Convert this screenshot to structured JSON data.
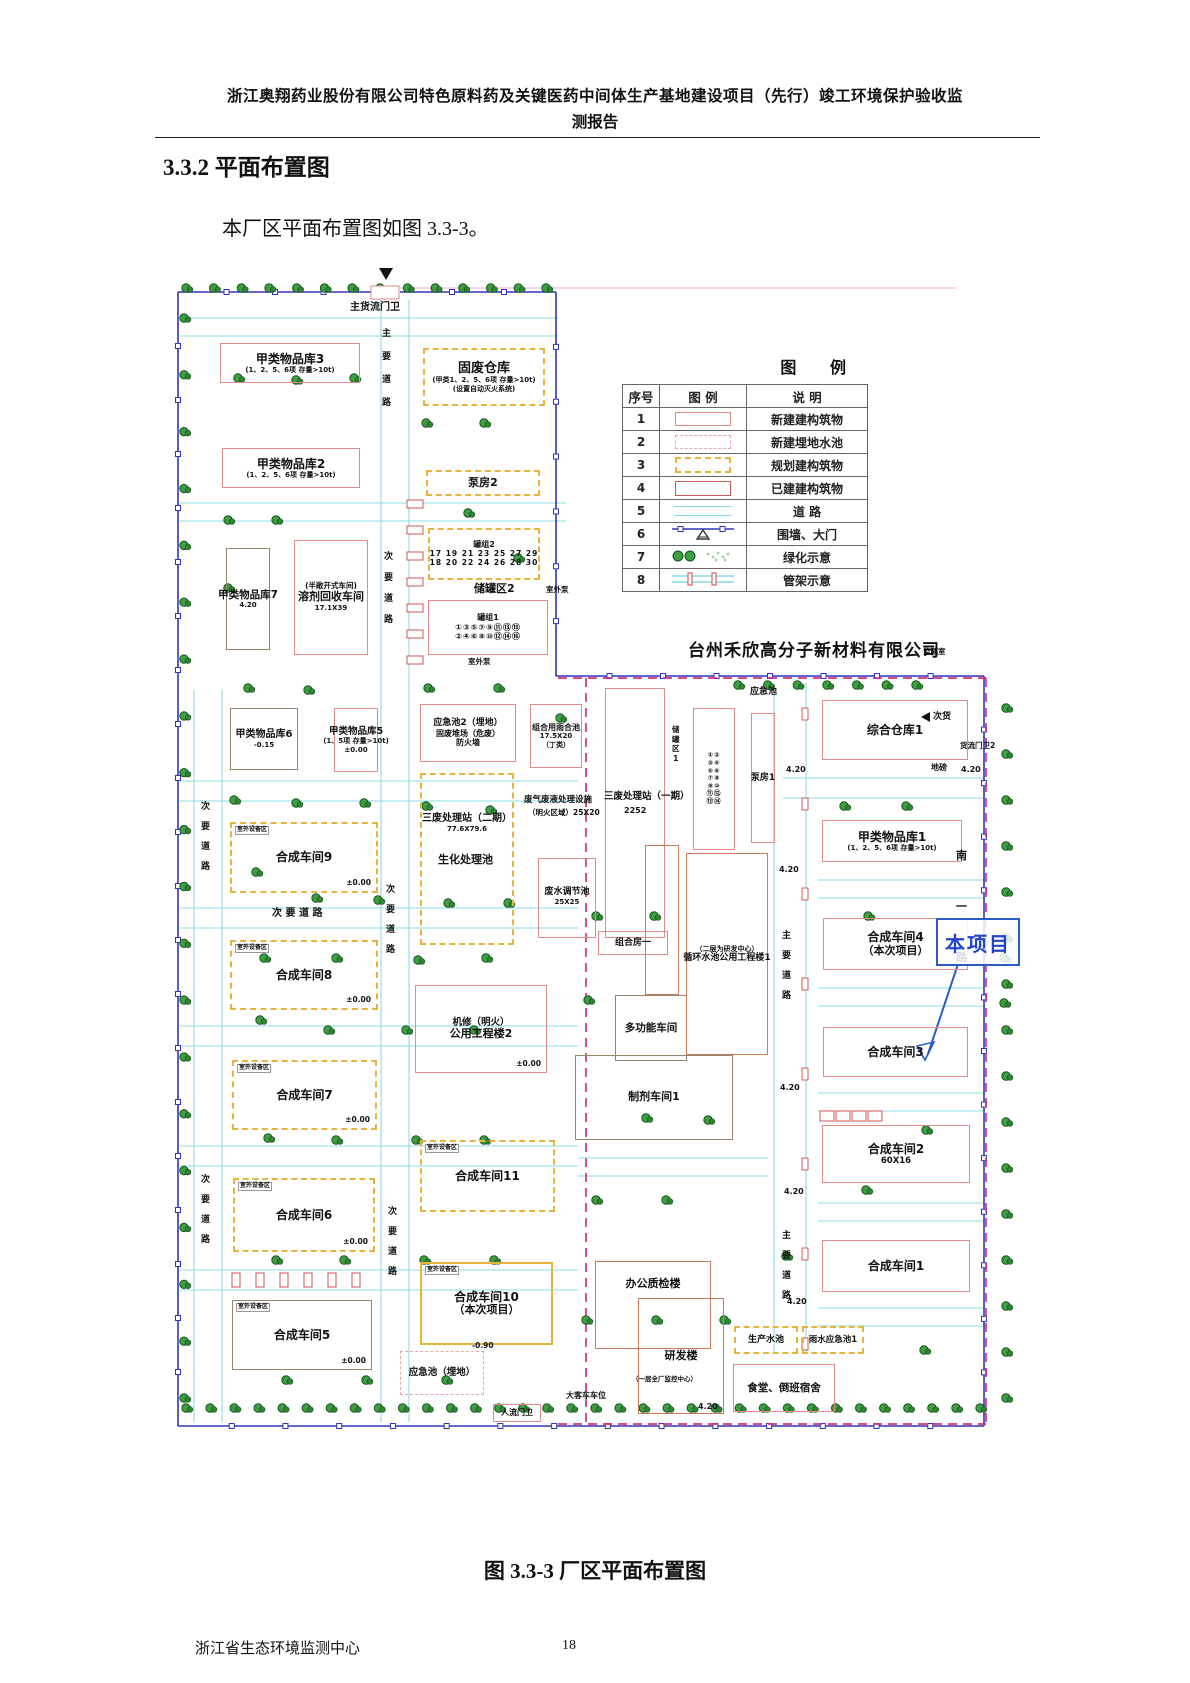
{
  "page": {
    "header_line1": "浙江奥翔药业股份有限公司特色原料药及关键医药中间体生产基地建设项目（先行）竣工环境保护验收监",
    "header_line2": "测报告",
    "section_heading": "3.3.2 平面布置图",
    "intro": "本厂区平面布置图如图 3.3-3。",
    "caption": "图 3.3-3  厂区平面布置图",
    "footer_org": "浙江省生态环境监测中心",
    "page_number": "18"
  },
  "legend": {
    "title": "图  例",
    "headers": [
      "序号",
      "图  例",
      "说  明"
    ],
    "rows": [
      {
        "no": "1",
        "swatch": "new-building",
        "desc": "新建建构筑物"
      },
      {
        "no": "2",
        "swatch": "new-buried-pool",
        "desc": "新建埋地水池"
      },
      {
        "no": "3",
        "swatch": "planned-building",
        "desc": "规划建构筑物"
      },
      {
        "no": "4",
        "swatch": "existing-building",
        "desc": "已建建构筑物"
      },
      {
        "no": "5",
        "swatch": "road",
        "desc": "道  路"
      },
      {
        "no": "6",
        "swatch": "wall-gate",
        "desc": "围墙、大门"
      },
      {
        "no": "7",
        "swatch": "greenery",
        "desc": "绿化示意"
      },
      {
        "no": "8",
        "swatch": "pipe-rack",
        "desc": "管架示意"
      }
    ]
  },
  "colors": {
    "new_building": "#e08a8a",
    "planned_building": "#e6b33c",
    "existing_building": "#cc5555",
    "gray_building": "#97866f",
    "orange_building": "#cc7a5a",
    "road": "#8adce4",
    "boundary_blue": "#3333bb",
    "boundary_magenta": "#d4317f",
    "tree_green": "#3f9d42",
    "callout_blue": "#2b5cc4"
  },
  "plan": {
    "neighbor_company": "台州禾欣高分子新材料有限公司",
    "callout": {
      "text": "本项目"
    },
    "buildings": [
      {
        "label": "甲类物品库3",
        "size": 12,
        "sub": [
          "(1、2、5、6项 存量>10t)"
        ],
        "type": "new",
        "rect": [
          52,
          85,
          140,
          40
        ]
      },
      {
        "label": "固废仓库",
        "size": 13,
        "sub": [
          "(甲类1、2、5、6项 存量>10t)",
          "(设置自动灭火系统)"
        ],
        "type": "planned",
        "rect": [
          255,
          90,
          122,
          58
        ]
      },
      {
        "label": "甲类物品库2",
        "size": 12,
        "sub": [
          "(1、2、5、6项 存量>10t)"
        ],
        "type": "new",
        "rect": [
          54,
          190,
          138,
          40
        ]
      },
      {
        "label": "泵房2",
        "size": 11,
        "type": "planned",
        "rect": [
          258,
          212,
          114,
          26
        ]
      },
      {
        "label": "甲类物品库7",
        "size": 10.5,
        "sub": [
          "4.20"
        ],
        "type": "gray",
        "rect": [
          58,
          290,
          44,
          102
        ]
      },
      {
        "label": "溶剂回收车间",
        "size": 11,
        "sub_top": "(半敞开式车间)",
        "subTopSize": 7.5,
        "sub": [
          "17.1X39"
        ],
        "type": "new",
        "rect": [
          126,
          282,
          74,
          115
        ]
      },
      {
        "label": "罐组2",
        "size": 8,
        "rows": [
          "17 19 21 23 25 27 29",
          "18 20 22 24 26 28 30"
        ],
        "rowSize": 7.5,
        "type": "planned",
        "rect": [
          260,
          270,
          112,
          52
        ]
      },
      {
        "label": "罐组1",
        "size": 8,
        "rows": [
          "①③⑤⑦⑨⑪⑬⑮",
          "②④⑥⑧⑩⑫⑭⑯"
        ],
        "rowSize": 8,
        "type": "new",
        "rect": [
          260,
          342,
          120,
          55
        ]
      },
      {
        "label": "甲类物品库6",
        "size": 10,
        "sub": [
          "-0.15"
        ],
        "type": "gray",
        "rect": [
          62,
          450,
          68,
          62
        ]
      },
      {
        "label": "甲类物品库5",
        "size": 9.5,
        "sub": [
          "(1、5项 存量>10t)",
          "±0.00"
        ],
        "type": "new",
        "rect": [
          166,
          450,
          44,
          64
        ]
      },
      {
        "label": "合成车间9",
        "size": 12,
        "corner": "室外设备区",
        "elev": "±0.00",
        "type": "planned",
        "rect": [
          62,
          564,
          148,
          71
        ]
      },
      {
        "label": "合成车间8",
        "size": 12,
        "corner": "室外设备区",
        "elev": "±0.00",
        "type": "planned",
        "rect": [
          62,
          682,
          148,
          70
        ]
      },
      {
        "label": "合成车间7",
        "size": 12,
        "corner": "室外设备区",
        "elev": "±0.00",
        "type": "planned",
        "rect": [
          64,
          802,
          145,
          70
        ]
      },
      {
        "label": "合成车间6",
        "size": 12,
        "corner": "室外设备区",
        "elev": "±0.00",
        "type": "planned",
        "rect": [
          65,
          920,
          142,
          74
        ]
      },
      {
        "label": "合成车间5",
        "size": 12,
        "corner": "室外设备区",
        "elev": "±0.00",
        "type": "gray",
        "rect": [
          64,
          1042,
          140,
          70
        ]
      },
      {
        "label": "应急池2（埋地）",
        "size": 9,
        "sub": [
          "固废堆场（危废）",
          "防火墙"
        ],
        "subSize": 8,
        "type": "new",
        "rect": [
          252,
          446,
          96,
          58
        ]
      },
      {
        "label": "组合用雨合池",
        "size": 8,
        "sub": [
          "17.5X20",
          "（丁类）"
        ],
        "type": "new",
        "rect": [
          362,
          446,
          52,
          64
        ]
      },
      {
        "label": "三废处理站（二期）",
        "size": 10,
        "sub": [
          "77.6X79.6"
        ],
        "align": "top",
        "padTop": 38,
        "type": "planned",
        "rect": [
          252,
          515,
          94,
          172
        ]
      },
      {
        "label": "公用工程楼2",
        "size": 11,
        "sub_top": "机修（明火）",
        "subTopSize": 9.5,
        "elev": "±0.00",
        "type": "new",
        "rect": [
          247,
          727,
          132,
          88
        ]
      },
      {
        "label": "合成车间11",
        "size": 12,
        "corner": "室外设备区",
        "type": "planned",
        "rect": [
          252,
          882,
          135,
          72
        ]
      },
      {
        "label": "合成车间10",
        "size": 12,
        "sub": [
          "（本次项目）"
        ],
        "subSize": 11,
        "corner": "室外设备区",
        "type": "current",
        "rect": [
          252,
          1004,
          133,
          83
        ]
      },
      {
        "label": "应急池（埋地）",
        "size": 9.5,
        "type": "buried",
        "rect": [
          232,
          1093,
          84,
          44
        ]
      },
      {
        "label": "人流门卫",
        "size": 8,
        "type": "new",
        "rect": [
          325,
          1146,
          48,
          18
        ]
      },
      {
        "label": "废水调节池",
        "size": 9,
        "sub": [
          "25X25"
        ],
        "align": "top",
        "padTop": 28,
        "type": "new",
        "rect": [
          370,
          600,
          58,
          80
        ]
      },
      {
        "label": "",
        "type": "new",
        "rect": [
          437,
          430,
          60,
          250
        ]
      },
      {
        "label": "",
        "rows": [
          "①②",
          "③④",
          "⑤⑥",
          "⑦⑧",
          "⑨⑩",
          "⑪⑫",
          "⑬⑭"
        ],
        "rowSize": 6.5,
        "type": "new",
        "rect": [
          525,
          450,
          42,
          142
        ]
      },
      {
        "label": "泵房1",
        "size": 9,
        "type": "new",
        "rect": [
          583,
          455,
          24,
          130
        ]
      },
      {
        "label": "综合仓库1",
        "size": 12,
        "type": "new",
        "rect": [
          654,
          442,
          146,
          60
        ]
      },
      {
        "label": "甲类物品库1",
        "size": 12,
        "sub": [
          "(1、2、5、6项 存量>10t)"
        ],
        "type": "new",
        "rect": [
          654,
          562,
          140,
          42
        ]
      },
      {
        "label": "合成车间4",
        "size": 12,
        "sub": [
          "（本次项目）"
        ],
        "subSize": 11,
        "type": "new",
        "rect": [
          655,
          660,
          145,
          52
        ]
      },
      {
        "label": "合成车间3",
        "size": 12,
        "type": "new",
        "rect": [
          655,
          769,
          145,
          50
        ]
      },
      {
        "label": "合成车间2",
        "size": 12,
        "sub": [
          "60X16"
        ],
        "subSize": 8.5,
        "type": "new",
        "rect": [
          654,
          867,
          148,
          58
        ]
      },
      {
        "label": "合成车间1",
        "size": 12,
        "type": "new",
        "rect": [
          654,
          982,
          148,
          52
        ]
      },
      {
        "label": "生产水池",
        "size": 9,
        "type": "planned",
        "rect": [
          566,
          1068,
          64,
          28
        ]
      },
      {
        "label": "雨水应急池1",
        "size": 8.5,
        "type": "planned",
        "rect": [
          634,
          1068,
          62,
          28
        ]
      },
      {
        "label": "食堂、倒班宿舍",
        "size": 10.5,
        "type": "new",
        "rect": [
          565,
          1106,
          102,
          48
        ]
      },
      {
        "label": "办公质检楼",
        "size": 11,
        "align": "top",
        "padTop": 16,
        "type": "orange",
        "rect": [
          427,
          1003,
          116,
          88
        ]
      },
      {
        "label": "研发楼",
        "size": 11,
        "type": "orange",
        "rect": [
          470,
          1040,
          86,
          116
        ]
      },
      {
        "label": "多功能车间",
        "size": 10.5,
        "type": "gray",
        "rect": [
          447,
          737,
          72,
          66
        ]
      },
      {
        "label": "制剂车间1",
        "size": 11,
        "type": "gray",
        "rect": [
          407,
          797,
          158,
          85
        ]
      },
      {
        "label": "循环水池公用工程楼1",
        "size": 9,
        "sub_top": "（二层为研发中心）",
        "subTopSize": 7,
        "type": "orange",
        "rect": [
          518,
          595,
          82,
          202
        ]
      },
      {
        "label": "",
        "type": "orange",
        "rect": [
          477,
          587,
          34,
          150
        ]
      },
      {
        "label": "组合房一",
        "size": 9,
        "type": "new",
        "rect": [
          430,
          673,
          70,
          24
        ]
      }
    ],
    "labels": [
      {
        "text": "主货流门卫",
        "x": 182,
        "y": 44,
        "size": 10
      },
      {
        "text": "储罐区2",
        "x": 306,
        "y": 325,
        "size": 11
      },
      {
        "text": "室外泵",
        "x": 378,
        "y": 328,
        "size": 7.5
      },
      {
        "text": "室外泵",
        "x": 300,
        "y": 400,
        "size": 7.5
      },
      {
        "text": "应急池",
        "x": 582,
        "y": 430,
        "size": 9
      },
      {
        "text": "三废处理站（一期）",
        "x": 436,
        "y": 534,
        "size": 9.5
      },
      {
        "text": "2252",
        "x": 456,
        "y": 549,
        "size": 8
      },
      {
        "text": "废气废液处理设施",
        "x": 356,
        "y": 538,
        "size": 8.5
      },
      {
        "text": "（明火区域）25X20",
        "x": 360,
        "y": 551,
        "size": 7.5
      },
      {
        "text": "生化处理池",
        "x": 270,
        "y": 596,
        "size": 11
      },
      {
        "text": "储罐区1",
        "x": 504,
        "y": 468,
        "size": 7.5,
        "v": true,
        "gap": 2
      },
      {
        "text": "地磅",
        "x": 763,
        "y": 506,
        "size": 8
      },
      {
        "text": "货流门卫2",
        "x": 792,
        "y": 484,
        "size": 7.5
      },
      {
        "text": "监测室",
        "x": 755,
        "y": 390,
        "size": 7.5
      },
      {
        "text": "次货",
        "x": 765,
        "y": 455,
        "size": 9
      },
      {
        "text": "大客车车位",
        "x": 398,
        "y": 1134,
        "size": 8
      },
      {
        "text": "（一层全厂监控中心）",
        "x": 464,
        "y": 1118,
        "size": 6.5
      },
      {
        "text": "-0.90",
        "x": 304,
        "y": 1084,
        "size": 7.5
      },
      {
        "text": "4.20",
        "x": 618,
        "y": 508,
        "size": 8
      },
      {
        "text": "4.20",
        "x": 793,
        "y": 508,
        "size": 8
      },
      {
        "text": "4.20",
        "x": 611,
        "y": 608,
        "size": 8
      },
      {
        "text": "4.20",
        "x": 612,
        "y": 826,
        "size": 8
      },
      {
        "text": "4.20",
        "x": 616,
        "y": 930,
        "size": 8
      },
      {
        "text": "4.20",
        "x": 619,
        "y": 1040,
        "size": 8
      },
      {
        "text": "4.20",
        "x": 530,
        "y": 1145,
        "size": 8
      }
    ],
    "road_labels": [
      {
        "text": "主要道路",
        "x": 214,
        "y": 72,
        "gap": 14
      },
      {
        "text": "次要道路",
        "x": 216,
        "y": 295,
        "gap": 12
      },
      {
        "text": "次要道路",
        "x": 33,
        "y": 545,
        "gap": 11
      },
      {
        "text": "次要道路",
        "x": 218,
        "y": 628,
        "gap": 11
      },
      {
        "text": "次 要 道 路",
        "x": 104,
        "y": 650,
        "size": 10,
        "h": true
      },
      {
        "text": "次要道路",
        "x": 33,
        "y": 918,
        "gap": 11
      },
      {
        "text": "次要道路",
        "x": 220,
        "y": 950,
        "gap": 11
      },
      {
        "text": "主要道路",
        "x": 614,
        "y": 674,
        "gap": 11
      },
      {
        "text": "主要道路",
        "x": 614,
        "y": 974,
        "gap": 11
      },
      {
        "text": "南一路",
        "x": 788,
        "y": 592,
        "gap": 40,
        "size": 11
      }
    ]
  }
}
